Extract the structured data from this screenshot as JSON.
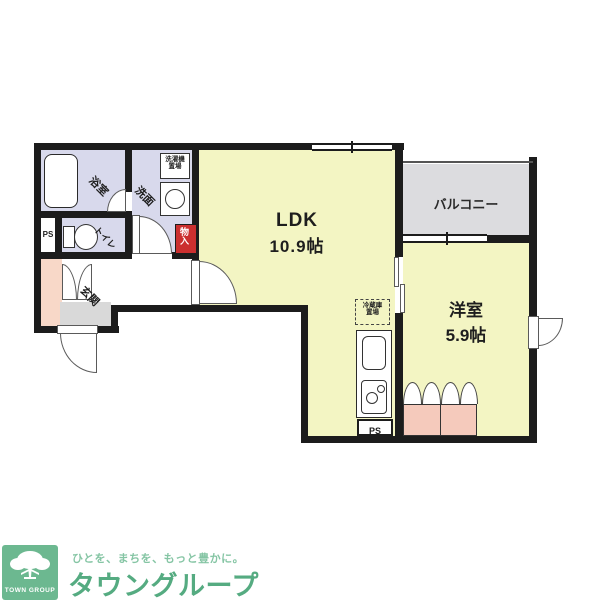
{
  "plan": {
    "ldk": {
      "name": "LDK",
      "size": "10.9帖"
    },
    "western_room": {
      "name": "洋室",
      "size": "5.9帖"
    },
    "balcony_label": "バルコニー",
    "bathroom_label": "浴室",
    "washroom_label": "洗面",
    "toilet_label": "トイレ",
    "entrance_label": "玄関",
    "storage_label": "物入",
    "pipe_space_left": "PS",
    "pipe_space_kitchen": "PS",
    "washer_place": {
      "line1": "洗濯機",
      "line2": "置場"
    },
    "fridge_place": {
      "line1": "冷蔵庫",
      "line2": "置場"
    }
  },
  "branding": {
    "logo_text": "TOWN GROUP",
    "tagline": "ひとを、まちを、もっと豊かに。",
    "company": "タウングループ"
  },
  "colors": {
    "wall": "#1c1c1c",
    "room_yellow": "#f3f5c3",
    "wet_lavender": "#d8d9ec",
    "entrance_pink": "#f8d8c8",
    "closet_pink": "#f5cabc",
    "balcony_gray": "#dcdcdf",
    "storage_red": "#cb2f2f",
    "logo_green": "#6cb890",
    "company_green": "#55ab81",
    "tagline_green": "#85c5a4"
  }
}
